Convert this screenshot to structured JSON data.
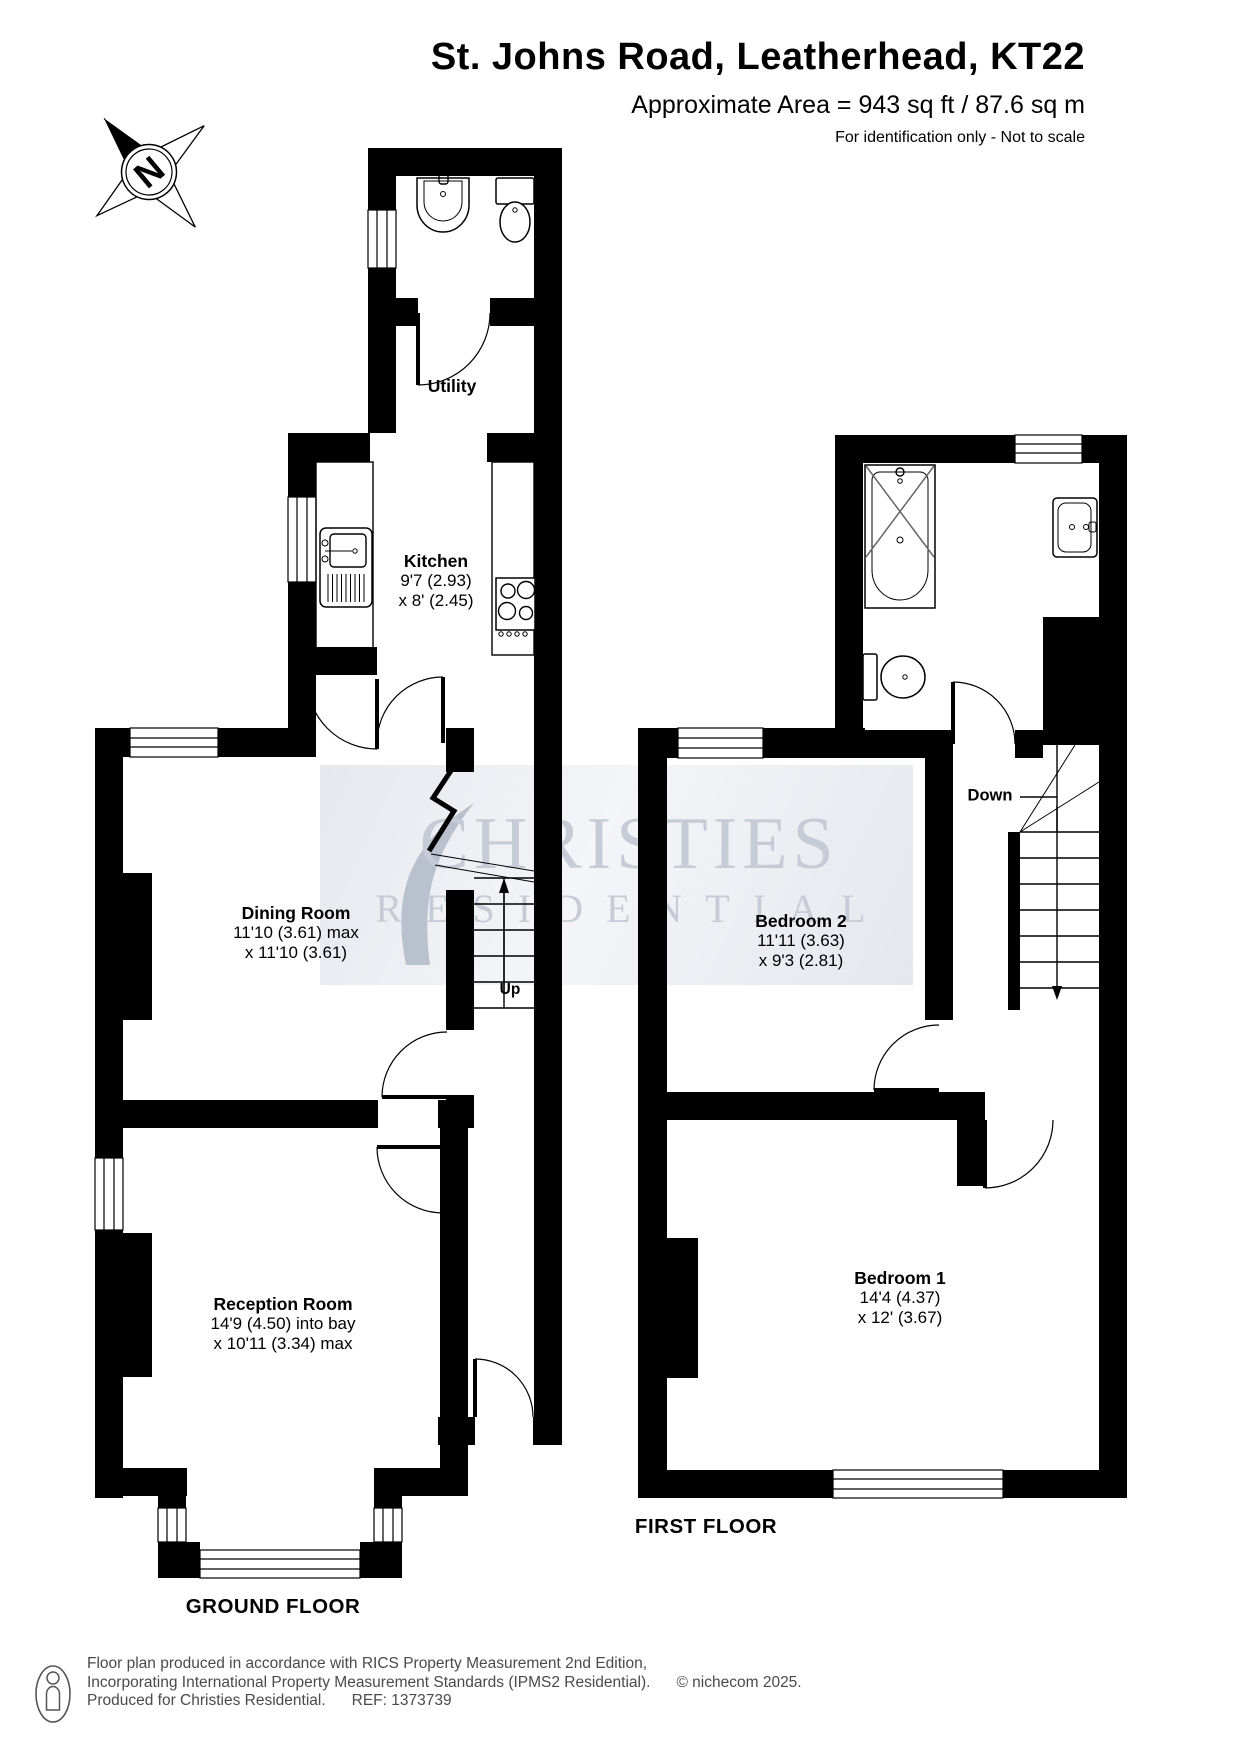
{
  "header": {
    "title": "St. Johns Road, Leatherhead, KT22",
    "area": "Approximate Area = 943 sq ft / 87.6 sq m",
    "disclaimer": "For identification only - Not to scale"
  },
  "compass": {
    "letter": "N"
  },
  "watermark": {
    "line1": "CHRISTIES",
    "line2": "RESIDENTIAL"
  },
  "ground_floor": {
    "floor_label": "GROUND FLOOR",
    "stairs_label": "Up",
    "rooms": {
      "utility": {
        "name": "Utility"
      },
      "kitchen": {
        "name": "Kitchen",
        "dim1": "9'7 (2.93)",
        "dim2": "x 8' (2.45)"
      },
      "dining": {
        "name": "Dining Room",
        "dim1": "11'10 (3.61) max",
        "dim2": "x 11'10 (3.61)"
      },
      "reception": {
        "name": "Reception Room",
        "dim1": "14'9 (4.50) into bay",
        "dim2": "x 10'11 (3.34) max"
      }
    }
  },
  "first_floor": {
    "floor_label": "FIRST FLOOR",
    "stairs_label": "Down",
    "rooms": {
      "bedroom2": {
        "name": "Bedroom 2",
        "dim1": "11'11 (3.63)",
        "dim2": "x 9'3 (2.81)"
      },
      "bedroom1": {
        "name": "Bedroom 1",
        "dim1": "14'4 (4.37)",
        "dim2": "x 12' (3.67)"
      }
    }
  },
  "footer": {
    "line1": "Floor plan produced in accordance with RICS Property Measurement 2nd Edition,",
    "line2": "Incorporating International Property Measurement Standards (IPMS2 Residential).",
    "copyright": "© nichecom 2025.",
    "line3": "Produced for Christies Residential.",
    "ref": "REF: 1373739"
  }
}
